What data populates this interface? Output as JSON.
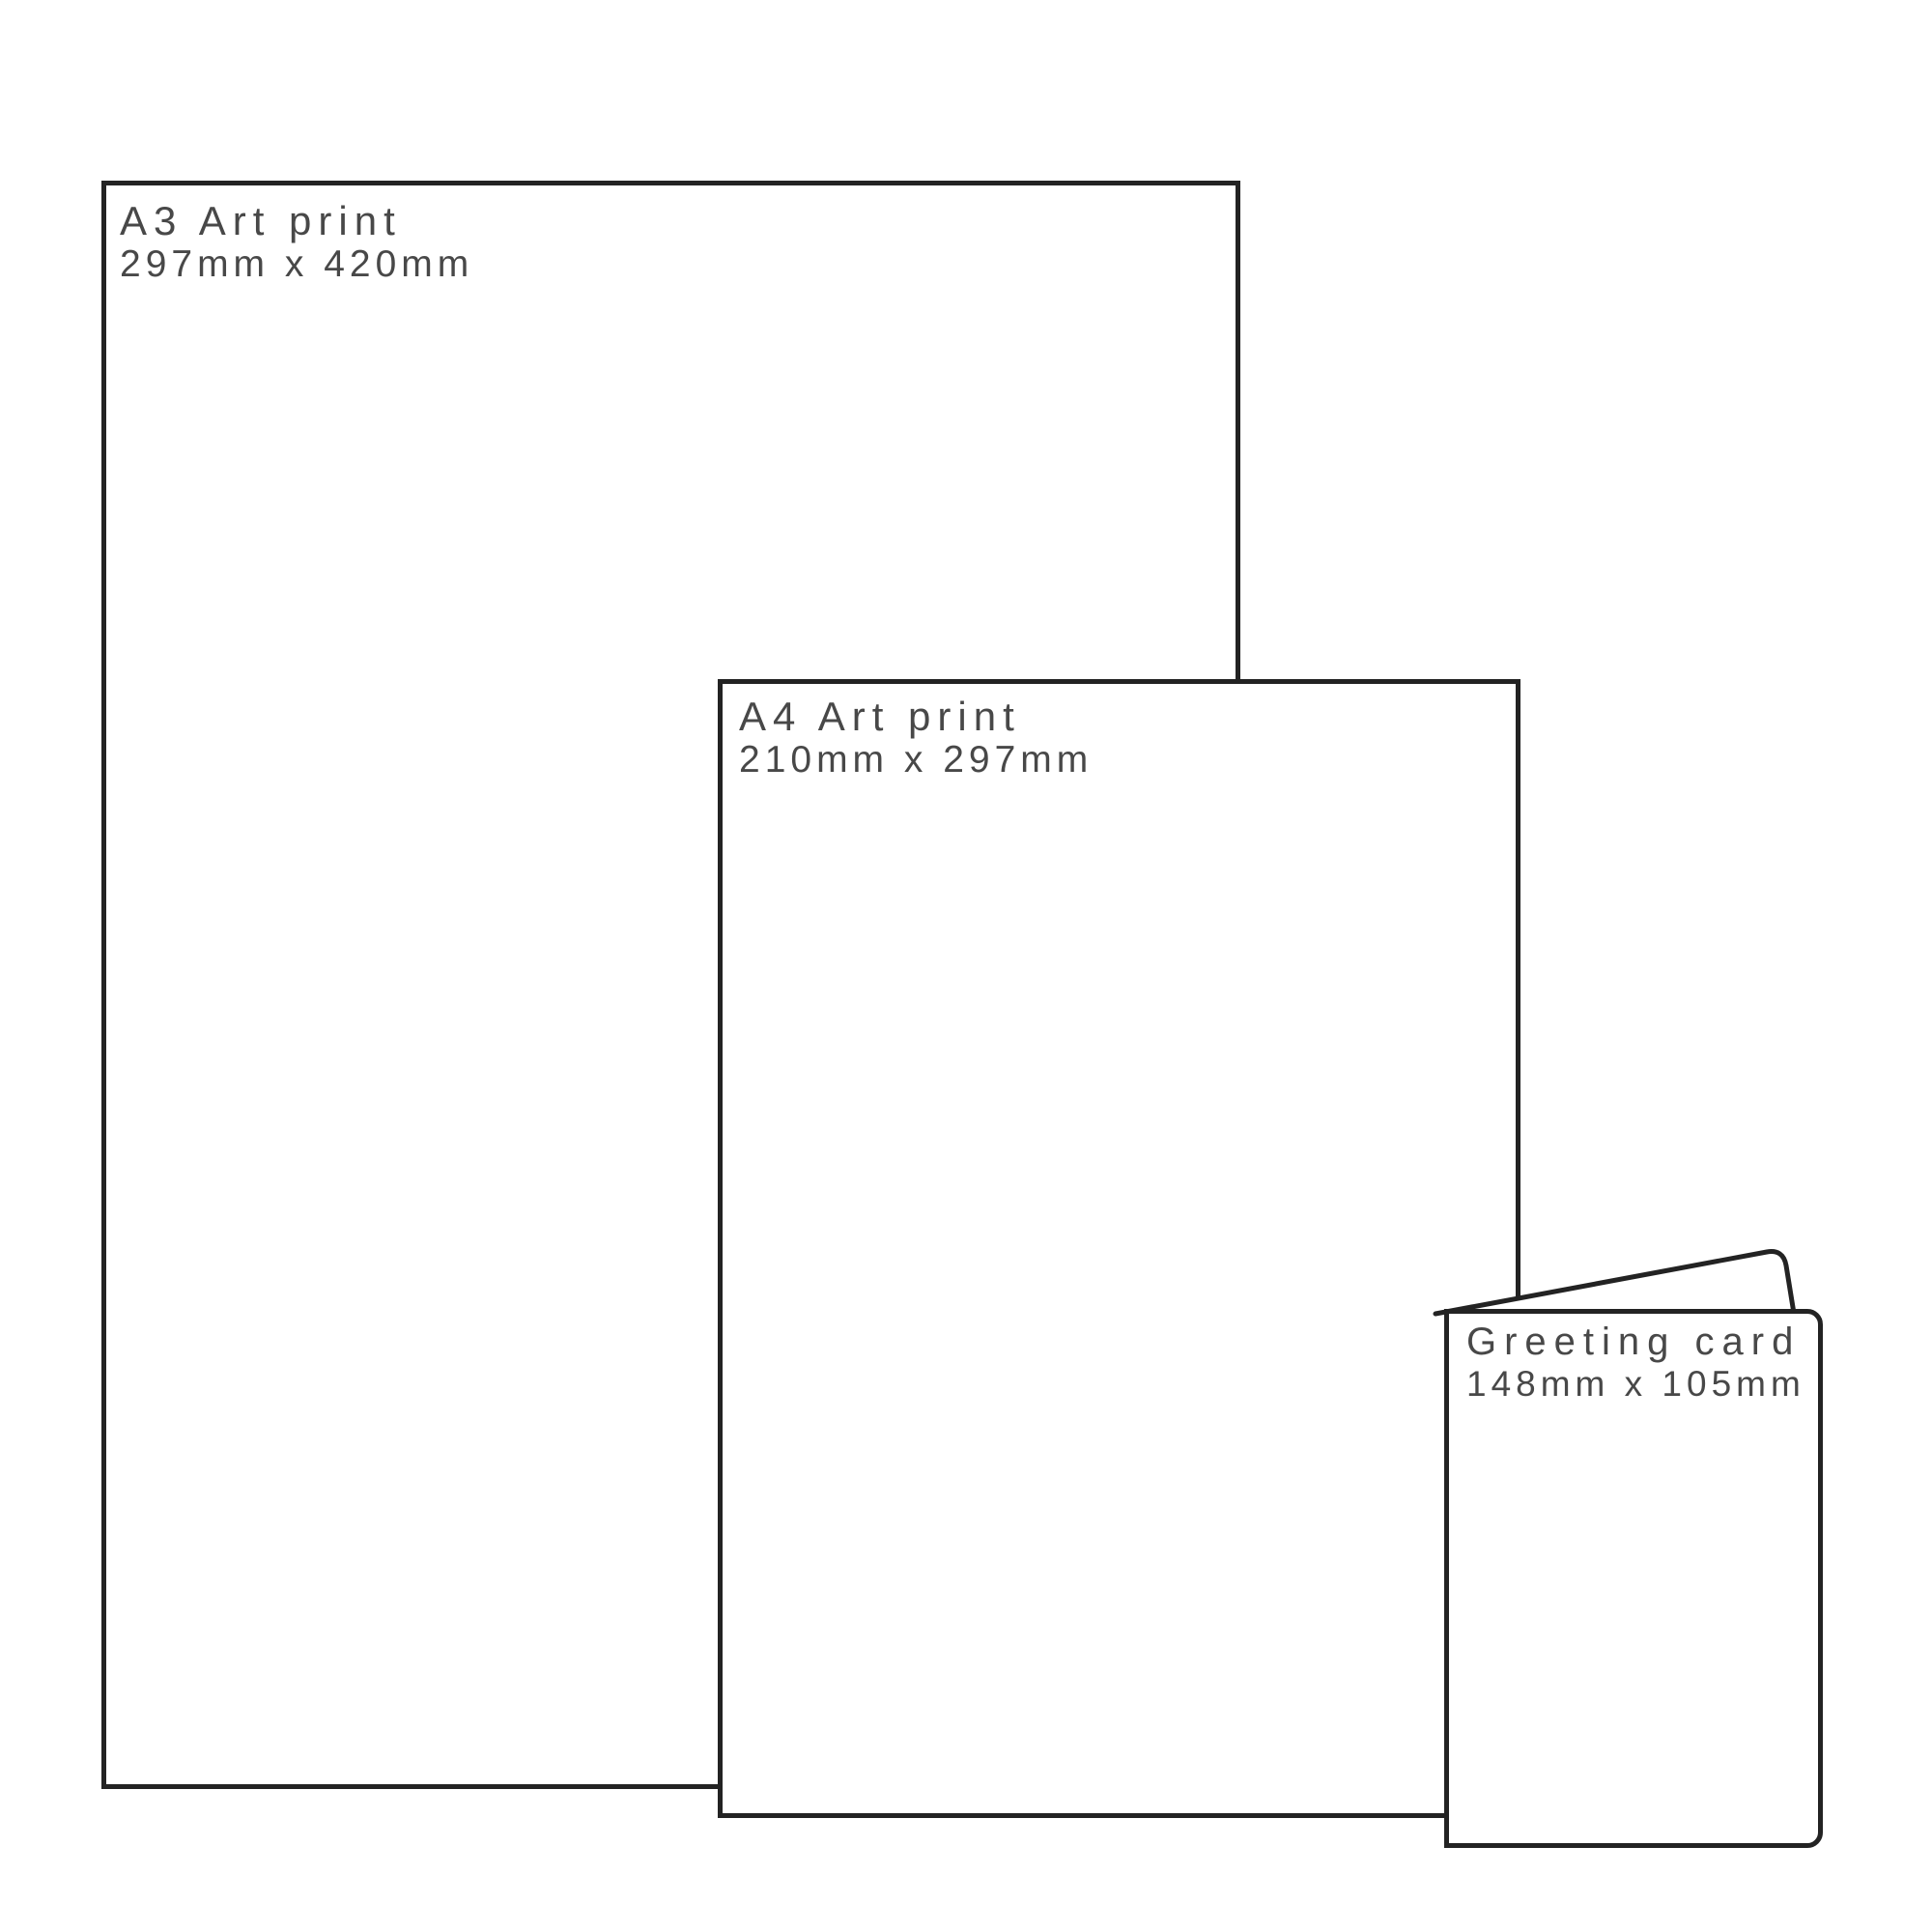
{
  "diagram": {
    "items": [
      {
        "title": "A3 Art print",
        "dimensions": "297mm x 420mm"
      },
      {
        "title": "A4 Art print",
        "dimensions": "210mm x 297mm"
      },
      {
        "title": "Greeting card",
        "dimensions": "148mm x 105mm"
      }
    ]
  },
  "colors": {
    "outline": "#232323",
    "label": "#484848",
    "background": "#ffffff"
  }
}
